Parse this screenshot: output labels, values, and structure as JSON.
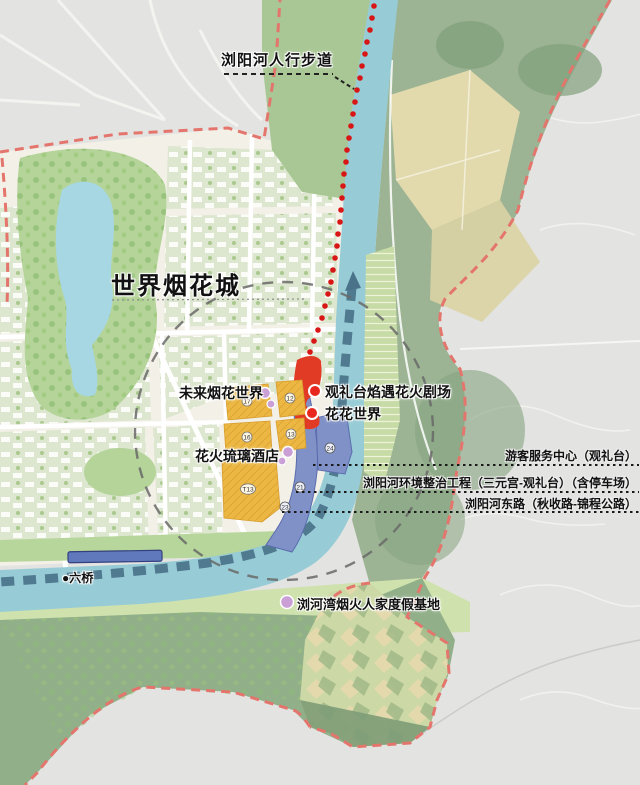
{
  "map": {
    "title_note": "世界烟花城总体规划图",
    "labels": {
      "walkway": "浏阳河人行步道",
      "city": "世界烟花城",
      "future_world": "未来烟花世界",
      "theater": "观礼台焰遇花火剧场",
      "flower_world": "花花世界",
      "hotel": "花火琉璃酒店",
      "bridge": "●六桥",
      "resort": "浏河湾烟火人家度假基地"
    },
    "callouts": [
      "游客服务中心（观礼台）",
      "浏阳河环境整治工程（三元宫-观礼台）（含停车场）",
      "浏阳河东路（秋收路-锦程公路）"
    ],
    "parcels": {
      "y1": "17",
      "y2": "12",
      "y3": "16",
      "y4": "13",
      "y5": "T13",
      "b1": "24",
      "b2": "21",
      "b3": "23"
    },
    "colors": {
      "river": "#97ccd6",
      "walkway_band": "#4a7389",
      "red_dots": "#d81616",
      "red_zone": "#e23b25",
      "blue_zone": "#7f91c6",
      "yellow_parcel": "#ecb843",
      "pink_marker": "#c99fd6",
      "boundary_dash": "#e4756d",
      "study_circle": "#686868",
      "park_green": "#b5d49a",
      "hill_green": "#91af89",
      "terrain_grey": "#e3e3e1"
    }
  }
}
